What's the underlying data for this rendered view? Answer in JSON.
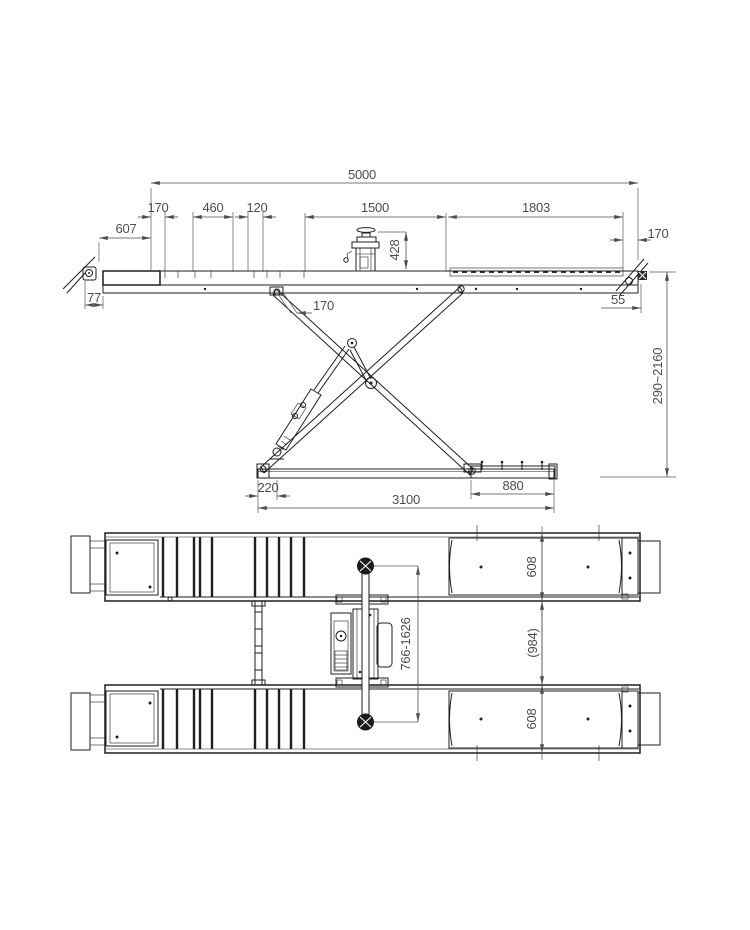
{
  "drawing": {
    "background": "#ffffff",
    "geometry_color": "#1f1f1f",
    "dimension_color": "#4d4d4d"
  },
  "side_view": {
    "dims": {
      "total_length": "5000",
      "seg_170_left": "170",
      "seg_460": "460",
      "seg_120": "120",
      "seg_1500": "1500",
      "seg_1803": "1803",
      "left_overhang": "607",
      "seg_170_right": "170",
      "power_unit_height": "428",
      "ramp_thickness": "77",
      "bracket_offset_170": "170",
      "right_edge_55": "55",
      "lift_height_range": "290~2160",
      "base_end_220": "220",
      "base_length_3100": "3100",
      "base_pad_880": "880"
    }
  },
  "plan_view": {
    "dims": {
      "front_platform_width": "608",
      "rear_platform_width": "608",
      "inner_track_width": "(984)",
      "lifting_pad_range": "766-1626"
    }
  }
}
